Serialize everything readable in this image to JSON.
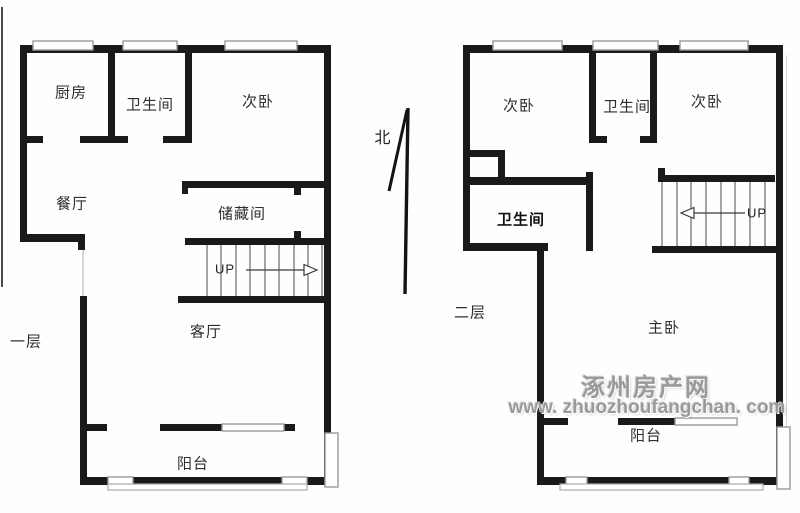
{
  "colors": {
    "wall": "#1a1a1a",
    "window_symbol": "#9a9a9a",
    "label_text": "#2e2e2e",
    "watermark": "#9a9a9a"
  },
  "compass": {
    "label": "北"
  },
  "floor1": {
    "label": "一层",
    "rooms": {
      "kitchen": "厨房",
      "bathroom": "卫生间",
      "bedroom": "次卧",
      "dining": "餐厅",
      "storage": "储藏间",
      "living": "客厅",
      "balcony": "阳台"
    },
    "stairs": {
      "label": "UP"
    }
  },
  "floor2": {
    "label": "二层",
    "rooms": {
      "bedroom_left": "次卧",
      "bathroom_top": "卫生间",
      "bedroom_right": "次卧",
      "bathroom_main": "卫生间",
      "master": "主卧",
      "balcony": "阳台"
    },
    "stairs": {
      "label": "UP"
    }
  },
  "watermark": {
    "site_name": "涿州房产网",
    "site_url": "www. zhuozhoufangchan. com"
  }
}
